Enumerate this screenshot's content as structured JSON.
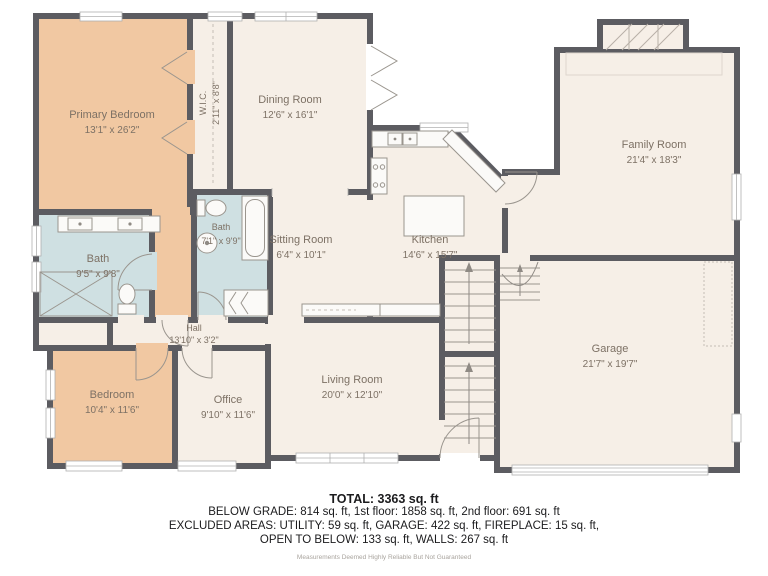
{
  "plan": {
    "rooms": [
      {
        "name": "Primary Bedroom",
        "dims": "13'1\" x 26'2\"",
        "fill": "peach"
      },
      {
        "name": "W.I.C.",
        "dims": "2'11\" x 8'8\"",
        "fill": "cream"
      },
      {
        "name": "Dining Room",
        "dims": "12'6\" x 16'1\"",
        "fill": "cream"
      },
      {
        "name": "Family Room",
        "dims": "21'4\" x 18'3\"",
        "fill": "cream"
      },
      {
        "name": "Bath",
        "dims": "9'5\" x 9'8\"",
        "fill": "blue"
      },
      {
        "name": "Bath",
        "dims": "7'1\" x 9'9\"",
        "fill": "blue"
      },
      {
        "name": "Sitting Room",
        "dims": "6'4\" x 10'1\"",
        "fill": "cream"
      },
      {
        "name": "Kitchen",
        "dims": "14'6\" x 15'7\"",
        "fill": "cream"
      },
      {
        "name": "Hall",
        "dims": "13'10\" x 3'2\"",
        "fill": "cream"
      },
      {
        "name": "Bedroom",
        "dims": "10'4\" x 11'6\"",
        "fill": "peach"
      },
      {
        "name": "Office",
        "dims": "9'10\" x 11'6\"",
        "fill": "cream"
      },
      {
        "name": "Living Room",
        "dims": "20'0\" x 12'10\"",
        "fill": "cream"
      },
      {
        "name": "Garage",
        "dims": "21'7\" x 19'7\"",
        "fill": "cream"
      }
    ],
    "colors": {
      "wall": "#5c5c61",
      "bedroom_fill": "#f1c8a2",
      "bath_fill": "#cfe0e2",
      "room_fill": "#f6efe7",
      "label_text": "#7d7165"
    }
  },
  "summary": {
    "total": "TOTAL: 3363 sq. ft",
    "lines": [
      "BELOW GRADE: 814 sq. ft, 1st floor: 1858 sq. ft, 2nd floor: 691 sq. ft",
      "EXCLUDED AREAS: UTILITY: 59 sq. ft, GARAGE: 422 sq. ft, FIREPLACE: 15 sq. ft,",
      "OPEN TO BELOW: 133 sq. ft, WALLS: 267 sq. ft"
    ],
    "disclaimer": "Measurements Deemed Highly Reliable But Not Guaranteed"
  }
}
